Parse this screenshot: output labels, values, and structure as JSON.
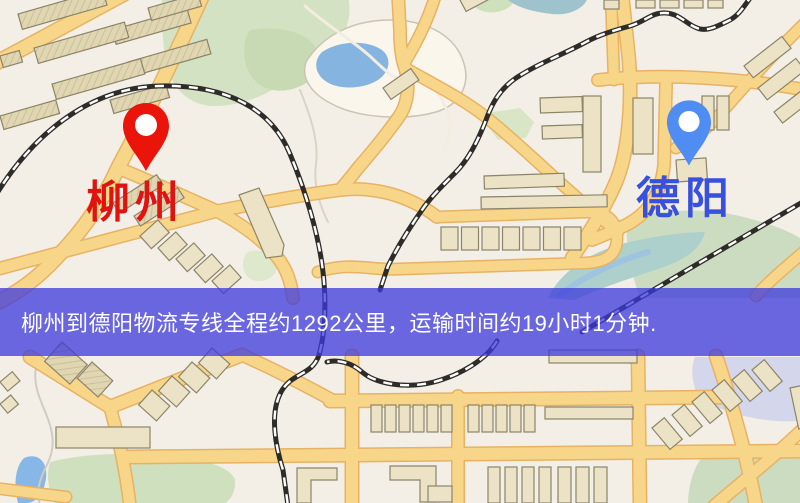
{
  "map": {
    "origin": {
      "label": "柳州",
      "label_color": "#e01310",
      "pin_color": "#ea140b",
      "pin_inner_color": "#ffffff"
    },
    "destination": {
      "label": "德阳",
      "label_color": "#3750dd",
      "pin_color": "#4f8df2",
      "pin_inner_color": "#ffffff"
    },
    "banner": {
      "text": "柳州到德阳物流专线全程约1292公里，运输时间约19小时1分钟.",
      "background_color": "#3c38de",
      "background_alpha": 0.75,
      "text_color": "#ffffff",
      "distance_km": 1292,
      "duration_text": "19小时1分钟"
    },
    "theme": {
      "land_color": "#f4efe6",
      "road_color": "#f7d68a",
      "road_casing_color": "#e7b264",
      "park_color": "#d3e2c2",
      "water_color": "#85b4e0",
      "railway_color": "#2e2c28",
      "building_color": "#ece3c6"
    }
  }
}
